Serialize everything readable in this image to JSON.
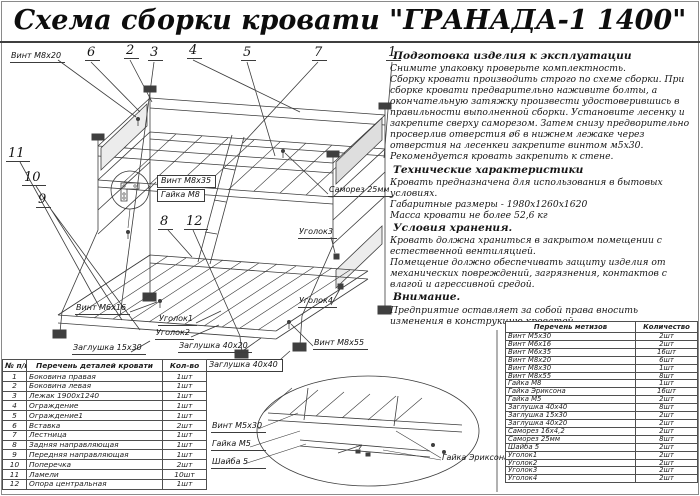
{
  "page": {
    "title": "Схема сборки кровати \"ГРАНАДА-1 1400\""
  },
  "colors": {
    "ink": "#1a1a1a",
    "line": "#3c3c3c"
  },
  "instructions": {
    "sections": [
      {
        "heading": "Подготовка изделия к эксплуатации",
        "text": "Снимите упаковку проверьте комплектность.\nСборку кровати производить строго по схеме сборки. При сборке кровати  предварительно наживите  болты, а окончательную затяжку произвести удостоверившись в правильности выполненной сборки. Установите лесенку и закрепите сверху саморезом. Затем снизу предворительно просверлив отверстия ø6 в нижнем лежаке через отверстия на лесенкеи закрепите винтом м5х30.\nРекомендуется кровать закрепить к стене."
      },
      {
        "heading": "Технические характеристики",
        "text": "Кровать предназначена для использования в бытовых условиях.\nГабаритные размеры - 1980х1260х1620\nМасса кровати не более 52,6 кг"
      },
      {
        "heading": "Условия хранения.",
        "text": "Кровать должна храниться в закрытом помещении с естественной вентиляцией.\nПомещение должно обеспечивать защиту изделия от механических повреждений, загрязнения, контактов с влагой и агрессивной средой."
      },
      {
        "heading": "Внимание.",
        "text": "Предприятие оставляет за собой права вносить изменения в конструкцию кроватей."
      }
    ]
  },
  "diagram": {
    "callouts": [
      "6",
      "2",
      "3",
      "4",
      "5",
      "7",
      "1",
      "11",
      "10",
      "9",
      "8",
      "12"
    ],
    "labels": {
      "vint_m8x20": "Винт М8х20",
      "vint_m8x35": "Винт М8х35",
      "gaika_m8": "Гайка М8",
      "samorez_25mm": "Саморез 25мм",
      "ugolok3": "Уголок3",
      "ugolok4": "Уголок4",
      "vint_m8x55": "Винт М8х55",
      "vint_m6x16": "Винт М6х16",
      "ugolok1": "Уголок1",
      "ugolok2": "Уголок2",
      "zaglushka_15x30": "Заглушка 15х30",
      "zaglushka_40x20": "Заглушка 40х20",
      "zaglushka_40x40": "Заглушка 40х40"
    }
  },
  "detail_view": {
    "labels": {
      "vint_m5x30": "Винт М5х30",
      "gaika_m5": "Гайка М5",
      "shayba_5": "Шайба 5",
      "gaika_eriksona": "Гайка Эриксона"
    }
  },
  "parts_table": {
    "headers": [
      "№ п/п",
      "Перечень деталей кровати",
      "Кол-во"
    ],
    "rows": [
      [
        "1",
        "Боковина правая",
        "1шт"
      ],
      [
        "2",
        "Боковина левая",
        "1шт"
      ],
      [
        "3",
        "Лежак 1900х1240",
        "1шт"
      ],
      [
        "4",
        "Ограждение",
        "1шт"
      ],
      [
        "5",
        "Ограждение1",
        "1шт"
      ],
      [
        "6",
        "Вставка",
        "2шт"
      ],
      [
        "7",
        "Лестница",
        "1шт"
      ],
      [
        "8",
        "Задняя направляющая",
        "1шт"
      ],
      [
        "9",
        "Передняя направляющая",
        "1шт"
      ],
      [
        "10",
        "Поперечка",
        "2шт"
      ],
      [
        "11",
        "Ламели",
        "10шт"
      ],
      [
        "12",
        "Опора центральная",
        "1шт"
      ]
    ]
  },
  "hardware_table": {
    "headers": [
      "Перечень метизов",
      "Количество"
    ],
    "rows": [
      [
        "Винт М5х30",
        "2шт"
      ],
      [
        "Винт М6х16",
        "2шт"
      ],
      [
        "Винт М6х35",
        "16шт"
      ],
      [
        "Винт М8х20",
        "6шт"
      ],
      [
        "Винт М8х30",
        "1шт"
      ],
      [
        "Винт М8х55",
        "8шт"
      ],
      [
        "Гайка М8",
        "1шт"
      ],
      [
        "Гайка Эриксона",
        "16шт"
      ],
      [
        "Гайка М5",
        "2шт"
      ],
      [
        "Заглушка 40х40",
        "8шт"
      ],
      [
        "Заглушка 15х30",
        "2шт"
      ],
      [
        "Заглушка 40х20",
        "2шт"
      ],
      [
        "Саморез 16х4,2",
        "2шт"
      ],
      [
        "Саморез 25мм",
        "8шт"
      ],
      [
        "Шайба 5",
        "2шт"
      ],
      [
        "Уголок1",
        "2шт"
      ],
      [
        "Уголок2",
        "2шт"
      ],
      [
        "Уголок3",
        "2шт"
      ],
      [
        "Уголок4",
        "2шт"
      ]
    ]
  }
}
